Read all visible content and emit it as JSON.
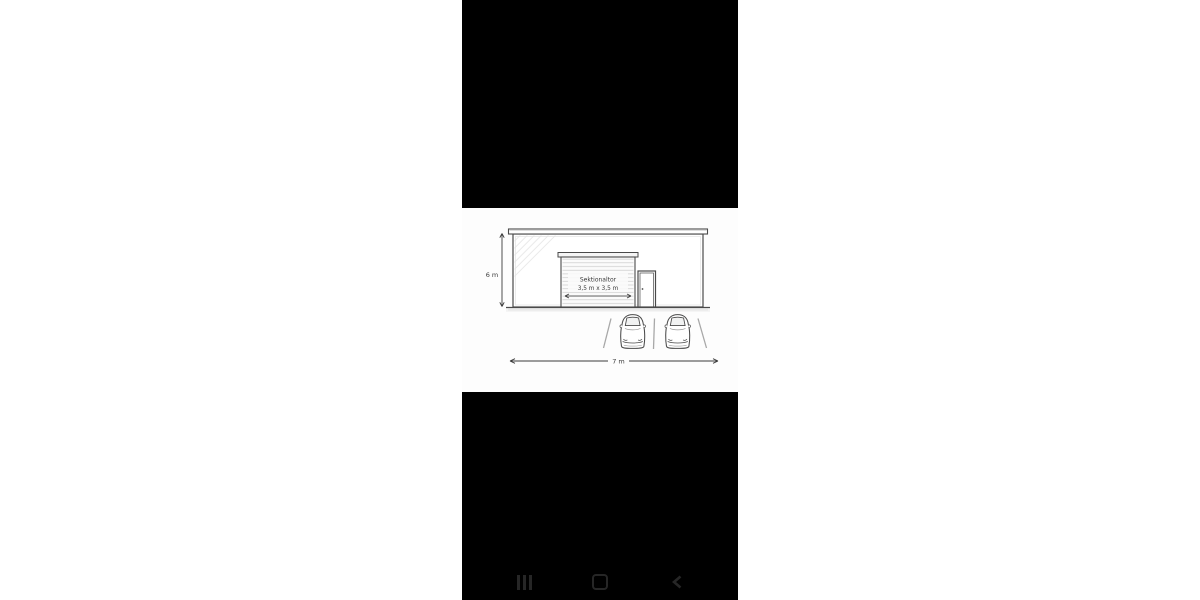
{
  "screen": {
    "page_background": "#ffffff",
    "phone_background": "#000000",
    "canvas_background": "#fdfdfd"
  },
  "diagram": {
    "door_label": "Sektionaltor",
    "door_size_label": "3,5 m x 3,5 m",
    "height_label": "6 m",
    "width_label": "7 m",
    "ink_color": "#4a4a4a",
    "dimension_color": "#3a3a3a",
    "slat_color": "#c9c9c9",
    "hatch_color": "#dcdcdc",
    "parking_line_color": "#a8a8a8"
  },
  "nav_bar": {
    "icon_color": "#262626",
    "buttons": [
      {
        "name": "recents"
      },
      {
        "name": "home"
      },
      {
        "name": "back"
      }
    ]
  }
}
